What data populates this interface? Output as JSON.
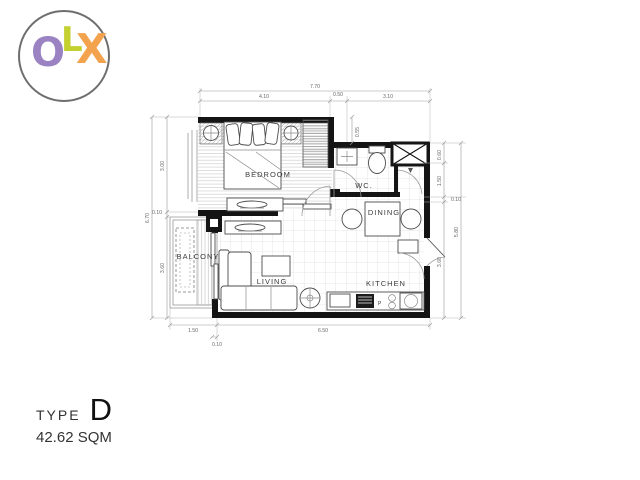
{
  "logo": {
    "o": "O",
    "l": "L",
    "x": "X"
  },
  "colors": {
    "o": "#9b82c2",
    "l": "#c4d02f",
    "x": "#f3a24d"
  },
  "plan": {
    "rooms": {
      "bedroom": "BEDROOM",
      "wc": "WC.",
      "dining": "DINING",
      "living": "LIVING",
      "kitchen": "KITCHEN",
      "balcony": "BALCONY"
    },
    "stove_label": "P",
    "dimensions": {
      "top_total": "7.70",
      "top_seg1": "4.10",
      "top_seg2": "0.50",
      "top_seg3": "3.10",
      "left_total": "6.70",
      "left_seg1": "3.00",
      "left_seg2": "0.10",
      "left_seg3": "3.60",
      "right_total": "5.80",
      "right_seg1": "0.60",
      "right_seg2": "1.50",
      "right_seg3": "0.10",
      "right_seg4": "3.60",
      "bottom_seg1": "1.50",
      "bottom_seg2": "6.50",
      "bottom_offset": "0.10",
      "wc_offset": "0.55"
    }
  },
  "footer": {
    "type_label": "TYPE",
    "type_value": "D",
    "area": "42.62 SQM"
  }
}
